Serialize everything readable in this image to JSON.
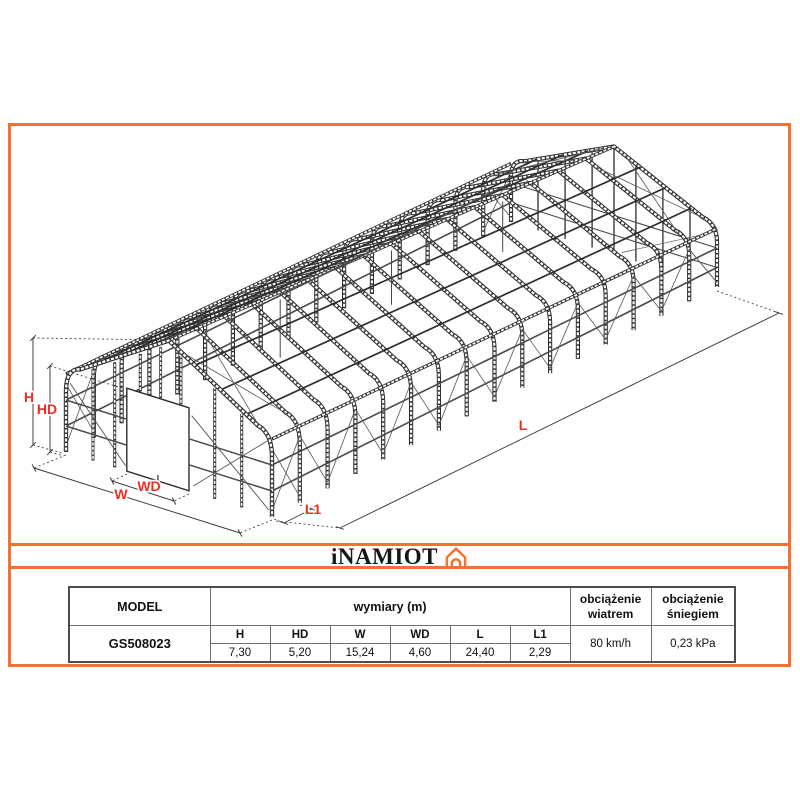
{
  "drawing": {
    "labels": {
      "h": "H",
      "hd": "HD",
      "w": "W",
      "wd": "WD",
      "l": "L",
      "l1": "L1"
    },
    "label_color": "#ee2e24",
    "line_color": "#2d2d2d",
    "frame_color": "#f4722f"
  },
  "logo": {
    "text": "iNAMIOT",
    "icon": "tent-icon",
    "accent": "#f4722f"
  },
  "table": {
    "headers": {
      "model": "MODEL",
      "dims": "wymiary (m)",
      "wind": "obciążenie wiatrem",
      "snow": "obciążenie śniegiem"
    },
    "model_value": "GS508023",
    "dim_labels": [
      "H",
      "HD",
      "W",
      "WD",
      "L",
      "L1"
    ],
    "dim_values": [
      "7,30",
      "5,20",
      "15,24",
      "4,60",
      "24,40",
      "2,29"
    ],
    "wind_value": "80 km/h",
    "snow_value": "0,23 kPa"
  }
}
